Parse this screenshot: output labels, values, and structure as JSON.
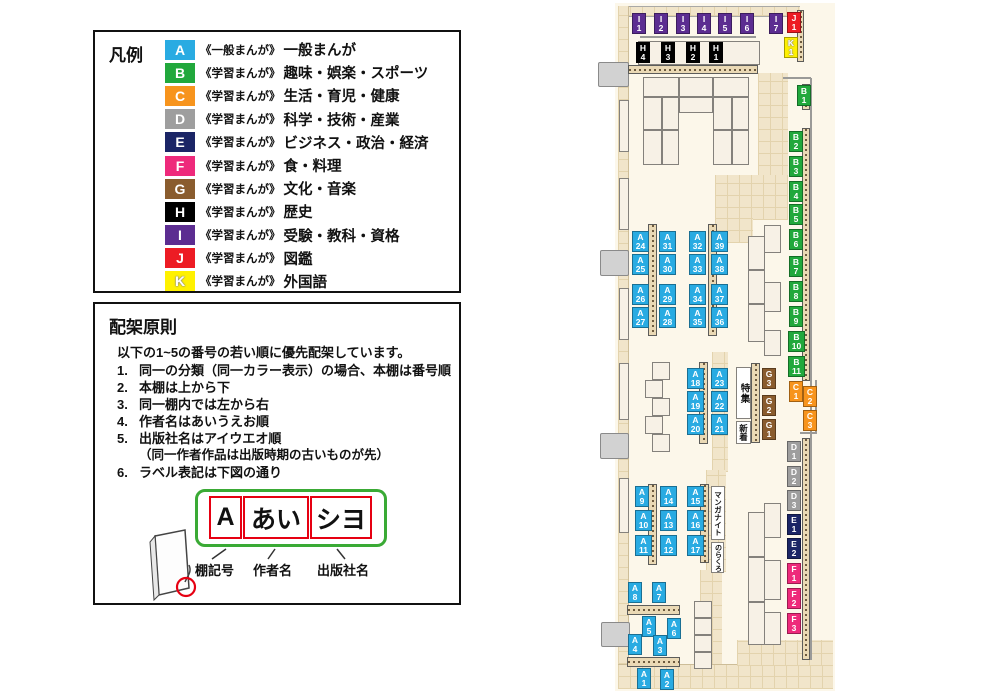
{
  "colors": {
    "A": "#29abe2",
    "B": "#21a83c",
    "C": "#f7941d",
    "D": "#9e9e9e",
    "E": "#1b2566",
    "F": "#ee2a7b",
    "G": "#8a5c2e",
    "H": "#000000",
    "I": "#5c2d91",
    "J": "#ed1c24",
    "K": "#fff100"
  },
  "legend": {
    "title": "凡例",
    "items": [
      {
        "code": "A",
        "series": "《一般まんが》",
        "name": "一般まんが"
      },
      {
        "code": "B",
        "series": "《学習まんが》",
        "name": "趣味・娯楽・スポーツ"
      },
      {
        "code": "C",
        "series": "《学習まんが》",
        "name": "生活・育児・健康"
      },
      {
        "code": "D",
        "series": "《学習まんが》",
        "name": "科学・技術・産業"
      },
      {
        "code": "E",
        "series": "《学習まんが》",
        "name": "ビジネス・政治・経済"
      },
      {
        "code": "F",
        "series": "《学習まんが》",
        "name": "食・料理"
      },
      {
        "code": "G",
        "series": "《学習まんが》",
        "name": "文化・音楽"
      },
      {
        "code": "H",
        "series": "《学習まんが》",
        "name": "歴史"
      },
      {
        "code": "I",
        "series": "《学習まんが》",
        "name": "受験・教科・資格"
      },
      {
        "code": "J",
        "series": "《学習まんが》",
        "name": "図鑑"
      },
      {
        "code": "K",
        "series": "《学習まんが》",
        "name": "外国語"
      }
    ]
  },
  "principles": {
    "title": "配架原則",
    "intro": "以下の1~5の番号の若い順に優先配架しています。",
    "items": [
      {
        "num": "1.",
        "text": "同一の分類（同一カラー表示）の場合、本棚は番号順"
      },
      {
        "num": "2.",
        "text": "本棚は上から下"
      },
      {
        "num": "3.",
        "text": "同一棚内では左から右"
      },
      {
        "num": "4.",
        "text": "作者名はあいうえお順"
      },
      {
        "num": "5.",
        "text": "出版社名はアイウエオ順",
        "sub": "（同一作者作品は出版時期の古いものが先）"
      },
      {
        "num": "6.",
        "text": "ラベル表記は下図の通り"
      }
    ],
    "label_example": {
      "shelf": "A",
      "author": "あい",
      "publisher": "シヨ",
      "captions": [
        "棚記号",
        "作者名",
        "出版社名"
      ]
    }
  },
  "map": {
    "areas": {
      "feature": "特集",
      "new": "新着",
      "manga_night": "マンガナイト",
      "norakuro": "のらくろ"
    },
    "labels": [
      {
        "t": "I1",
        "x": 632,
        "y": 13
      },
      {
        "t": "I2",
        "x": 654,
        "y": 13
      },
      {
        "t": "I3",
        "x": 676,
        "y": 13
      },
      {
        "t": "I4",
        "x": 697,
        "y": 13
      },
      {
        "t": "I5",
        "x": 718,
        "y": 13
      },
      {
        "t": "I6",
        "x": 740,
        "y": 13
      },
      {
        "t": "I7",
        "x": 769,
        "y": 13
      },
      {
        "t": "J1",
        "x": 787,
        "y": 12
      },
      {
        "t": "K1",
        "x": 784,
        "y": 37
      },
      {
        "t": "H4",
        "x": 636,
        "y": 42
      },
      {
        "t": "H3",
        "x": 661,
        "y": 42
      },
      {
        "t": "H2",
        "x": 686,
        "y": 42
      },
      {
        "t": "H1",
        "x": 709,
        "y": 42
      },
      {
        "t": "B1",
        "x": 797,
        "y": 85
      },
      {
        "t": "B2",
        "x": 789,
        "y": 131
      },
      {
        "t": "B3",
        "x": 789,
        "y": 156
      },
      {
        "t": "B4",
        "x": 789,
        "y": 181
      },
      {
        "t": "B5",
        "x": 789,
        "y": 204
      },
      {
        "t": "B6",
        "x": 789,
        "y": 229
      },
      {
        "t": "B7",
        "x": 789,
        "y": 256
      },
      {
        "t": "B8",
        "x": 789,
        "y": 281
      },
      {
        "t": "B9",
        "x": 789,
        "y": 306
      },
      {
        "t": "B10",
        "x": 788,
        "y": 331
      },
      {
        "t": "B11",
        "x": 788,
        "y": 356
      },
      {
        "t": "C1",
        "x": 789,
        "y": 381
      },
      {
        "t": "C2",
        "x": 803,
        "y": 386
      },
      {
        "t": "C3",
        "x": 803,
        "y": 410
      },
      {
        "t": "G3",
        "x": 762,
        "y": 368
      },
      {
        "t": "G2",
        "x": 762,
        "y": 395
      },
      {
        "t": "G1",
        "x": 762,
        "y": 419
      },
      {
        "t": "D1",
        "x": 787,
        "y": 441
      },
      {
        "t": "D2",
        "x": 787,
        "y": 466
      },
      {
        "t": "D3",
        "x": 787,
        "y": 490
      },
      {
        "t": "E1",
        "x": 787,
        "y": 514
      },
      {
        "t": "E2",
        "x": 787,
        "y": 538
      },
      {
        "t": "F1",
        "x": 787,
        "y": 563
      },
      {
        "t": "F2",
        "x": 787,
        "y": 588
      },
      {
        "t": "F3",
        "x": 787,
        "y": 613
      },
      {
        "t": "A24",
        "x": 632,
        "y": 231
      },
      {
        "t": "A25",
        "x": 632,
        "y": 254
      },
      {
        "t": "A26",
        "x": 632,
        "y": 284
      },
      {
        "t": "A27",
        "x": 632,
        "y": 307
      },
      {
        "t": "A31",
        "x": 659,
        "y": 231
      },
      {
        "t": "A30",
        "x": 659,
        "y": 254
      },
      {
        "t": "A29",
        "x": 659,
        "y": 284
      },
      {
        "t": "A28",
        "x": 659,
        "y": 307
      },
      {
        "t": "A32",
        "x": 689,
        "y": 231
      },
      {
        "t": "A33",
        "x": 689,
        "y": 254
      },
      {
        "t": "A34",
        "x": 689,
        "y": 284
      },
      {
        "t": "A35",
        "x": 689,
        "y": 307
      },
      {
        "t": "A39",
        "x": 711,
        "y": 231
      },
      {
        "t": "A38",
        "x": 711,
        "y": 254
      },
      {
        "t": "A37",
        "x": 711,
        "y": 284
      },
      {
        "t": "A36",
        "x": 711,
        "y": 307
      },
      {
        "t": "A18",
        "x": 687,
        "y": 368
      },
      {
        "t": "A19",
        "x": 687,
        "y": 391
      },
      {
        "t": "A20",
        "x": 687,
        "y": 414
      },
      {
        "t": "A23",
        "x": 711,
        "y": 368
      },
      {
        "t": "A22",
        "x": 711,
        "y": 391
      },
      {
        "t": "A21",
        "x": 711,
        "y": 414
      },
      {
        "t": "A9",
        "x": 635,
        "y": 486
      },
      {
        "t": "A10",
        "x": 635,
        "y": 510
      },
      {
        "t": "A11",
        "x": 635,
        "y": 535
      },
      {
        "t": "A14",
        "x": 660,
        "y": 486
      },
      {
        "t": "A13",
        "x": 660,
        "y": 510
      },
      {
        "t": "A12",
        "x": 660,
        "y": 535
      },
      {
        "t": "A15",
        "x": 687,
        "y": 486
      },
      {
        "t": "A16",
        "x": 687,
        "y": 510
      },
      {
        "t": "A17",
        "x": 687,
        "y": 535
      },
      {
        "t": "A8",
        "x": 628,
        "y": 582
      },
      {
        "t": "A7",
        "x": 652,
        "y": 582
      },
      {
        "t": "A5",
        "x": 642,
        "y": 616
      },
      {
        "t": "A6",
        "x": 667,
        "y": 618
      },
      {
        "t": "A4",
        "x": 628,
        "y": 634
      },
      {
        "t": "A3",
        "x": 653,
        "y": 635
      },
      {
        "t": "A1",
        "x": 637,
        "y": 668
      },
      {
        "t": "A2",
        "x": 660,
        "y": 669
      }
    ]
  }
}
